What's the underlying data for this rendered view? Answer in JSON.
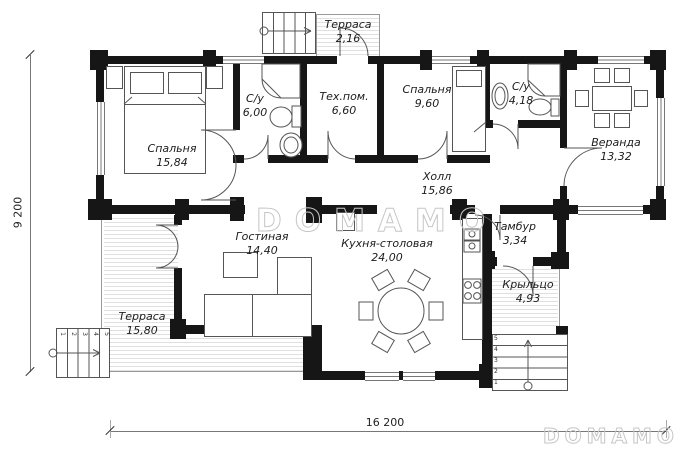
{
  "plan": {
    "watermark_center": "DOMAMO",
    "watermark_corner": "DOMAMO",
    "dim_vertical": "9 200",
    "dim_horizontal": "16 200",
    "rooms": {
      "terrace_top": {
        "name": "Терраса",
        "area": "2,16"
      },
      "bedroom1": {
        "name": "Спальня",
        "area": "15,84"
      },
      "bath1": {
        "name": "С/у",
        "area": "6,00"
      },
      "tech": {
        "name": "Тех.пом.",
        "area": "6,60"
      },
      "bedroom2": {
        "name": "Спальня",
        "area": "9,60"
      },
      "bath2": {
        "name": "С/у",
        "area": "4,18"
      },
      "veranda": {
        "name": "Веранда",
        "area": "13,32"
      },
      "hall": {
        "name": "Холл",
        "area": "15,86"
      },
      "living": {
        "name": "Гостиная",
        "area": "14,40"
      },
      "kitchen": {
        "name": "Кухня-столовая",
        "area": "24,00"
      },
      "tambour": {
        "name": "Тамбур",
        "area": "3,34"
      },
      "porch": {
        "name": "Крыльцо",
        "area": "4,93"
      },
      "terrace_left": {
        "name": "Терраса",
        "area": "15,80"
      }
    },
    "porch_step_numbers": [
      "5",
      "4",
      "3",
      "2",
      "1"
    ],
    "stair_step_numbers": [
      "1",
      "2",
      "3",
      "4",
      "5"
    ],
    "colors": {
      "wall": "#161616",
      "line": "#555555",
      "hatch": "#e0e0e0",
      "watermark": "#c6c6c6"
    }
  }
}
